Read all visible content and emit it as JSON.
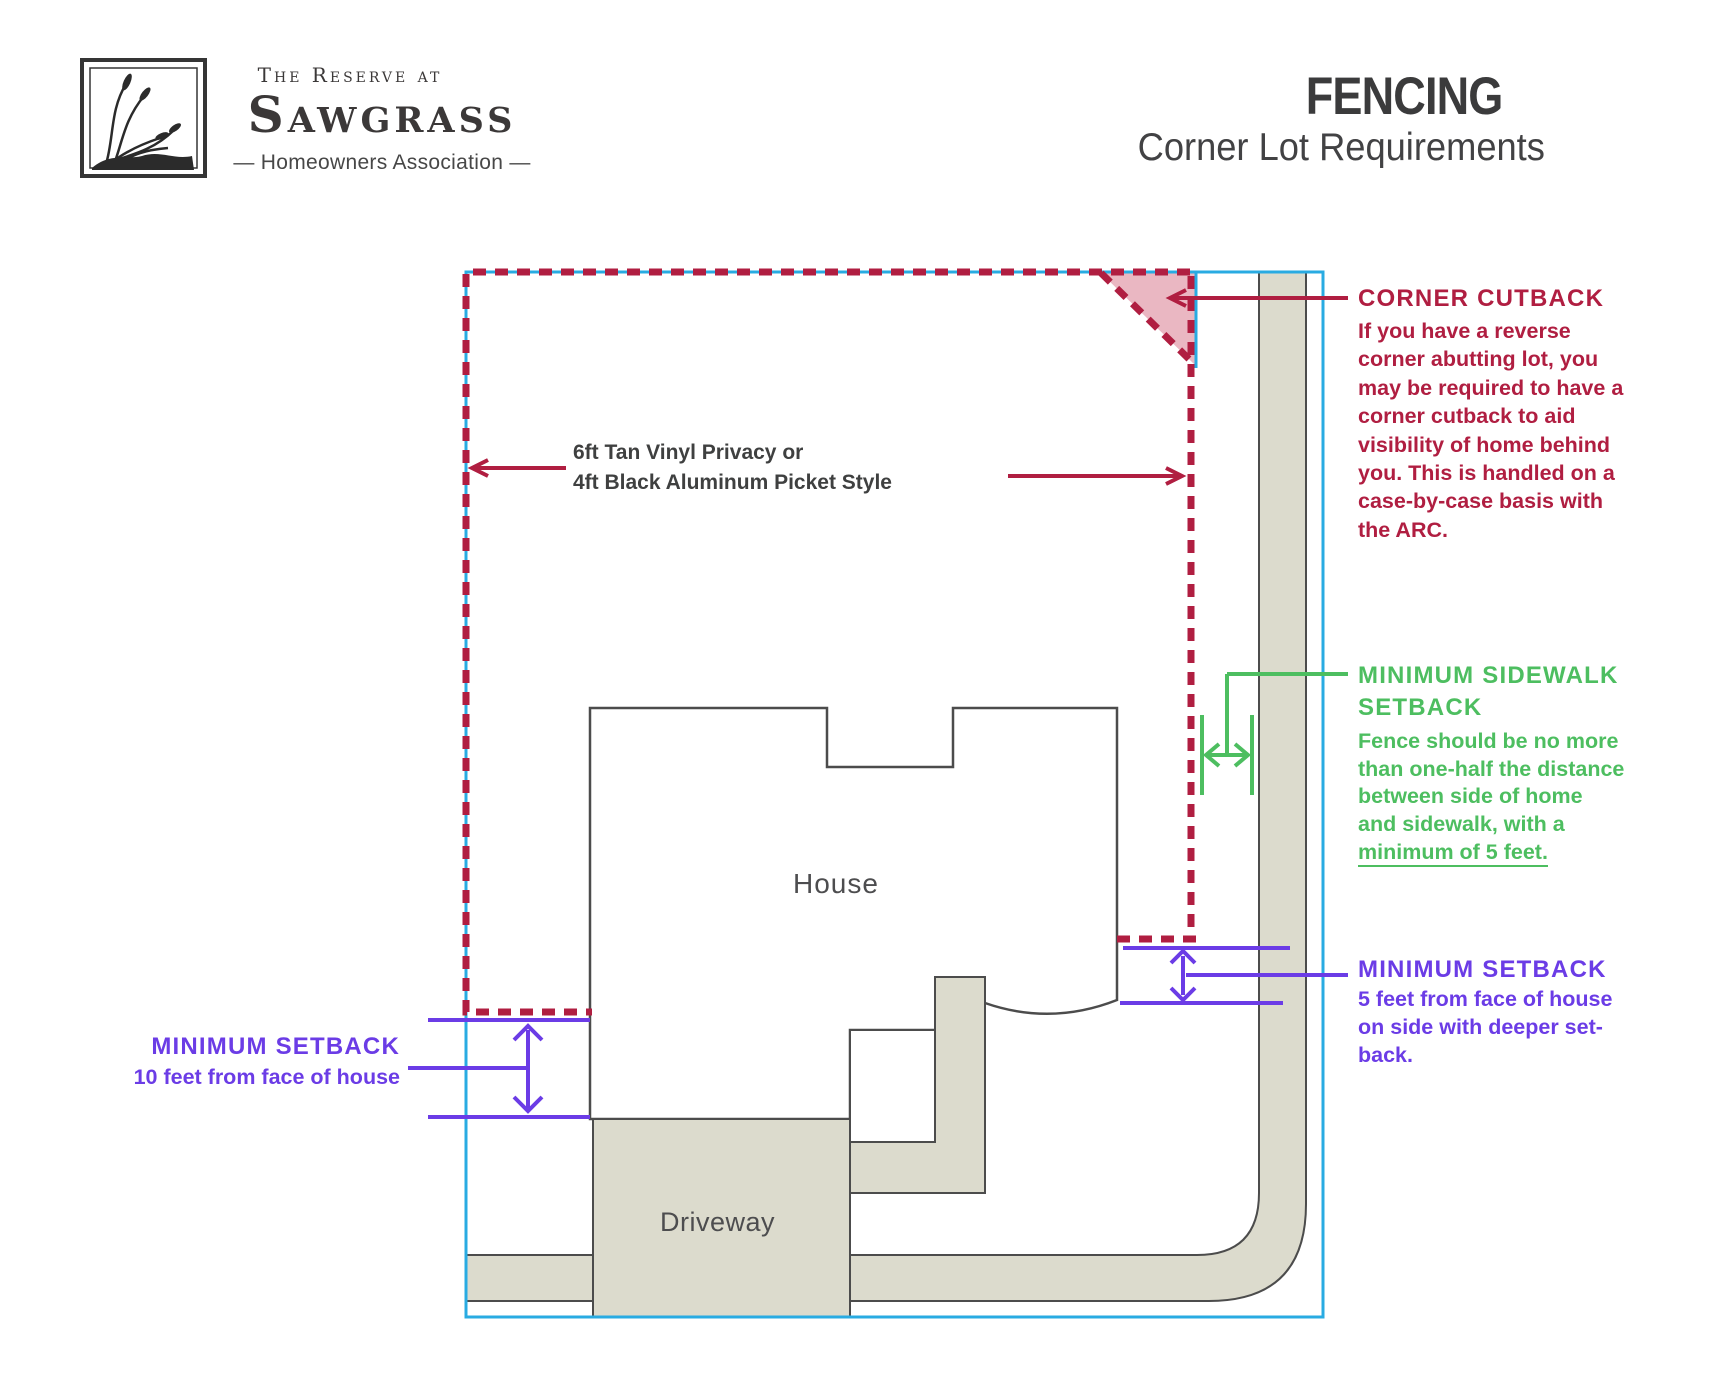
{
  "logo": {
    "name_top": "The Reserve at",
    "name_main": "Sawgrass",
    "tagline": "— Homeowners Association —"
  },
  "title": {
    "main": "FENCING",
    "subtitle": "Corner Lot Requirements"
  },
  "diagram": {
    "house_label": "House",
    "driveway_label": "Driveway",
    "fence_label_line1": "6ft Tan Vinyl Privacy or",
    "fence_label_line2": "4ft Black Aluminum Picket Style"
  },
  "annotations": {
    "corner_cutback": {
      "heading": "CORNER CUTBACK",
      "line1": "If you have a reverse",
      "line2": "corner abutting lot, you",
      "line3_bold": "may",
      "line3_rest": " be required to have a",
      "line4": "corner cutback to aid",
      "line5": "visibility of home behind",
      "line6": "you. This is handled on a",
      "line7": "case-by-case basis with",
      "line8": "the ARC."
    },
    "sidewalk_setback": {
      "heading_line1": "MINIMUM SIDEWALK",
      "heading_line2": "SETBACK",
      "line1": "Fence should be no more",
      "line2": "than one-half the distance",
      "line3": "between side of home",
      "line4": "and sidewalk, with a",
      "line5_emphasis": "minimum of 5 feet."
    },
    "setback_right": {
      "heading": "MINIMUM SETBACK",
      "line1": "5 feet from face of house",
      "line2": "on side with deeper set-",
      "line3": "back."
    },
    "setback_left": {
      "heading": "MINIMUM SETBACK",
      "line1": "10 feet from face of house"
    }
  },
  "colors": {
    "crimson": "#b01e41",
    "cyan": "#29abe2",
    "green": "#4dbe60",
    "purple": "#6b3ce6",
    "tan": "#dcdbcd",
    "pink": "#eab7c2",
    "outline_gray": "#4c4c4c",
    "text_dark": "#3f4040"
  }
}
